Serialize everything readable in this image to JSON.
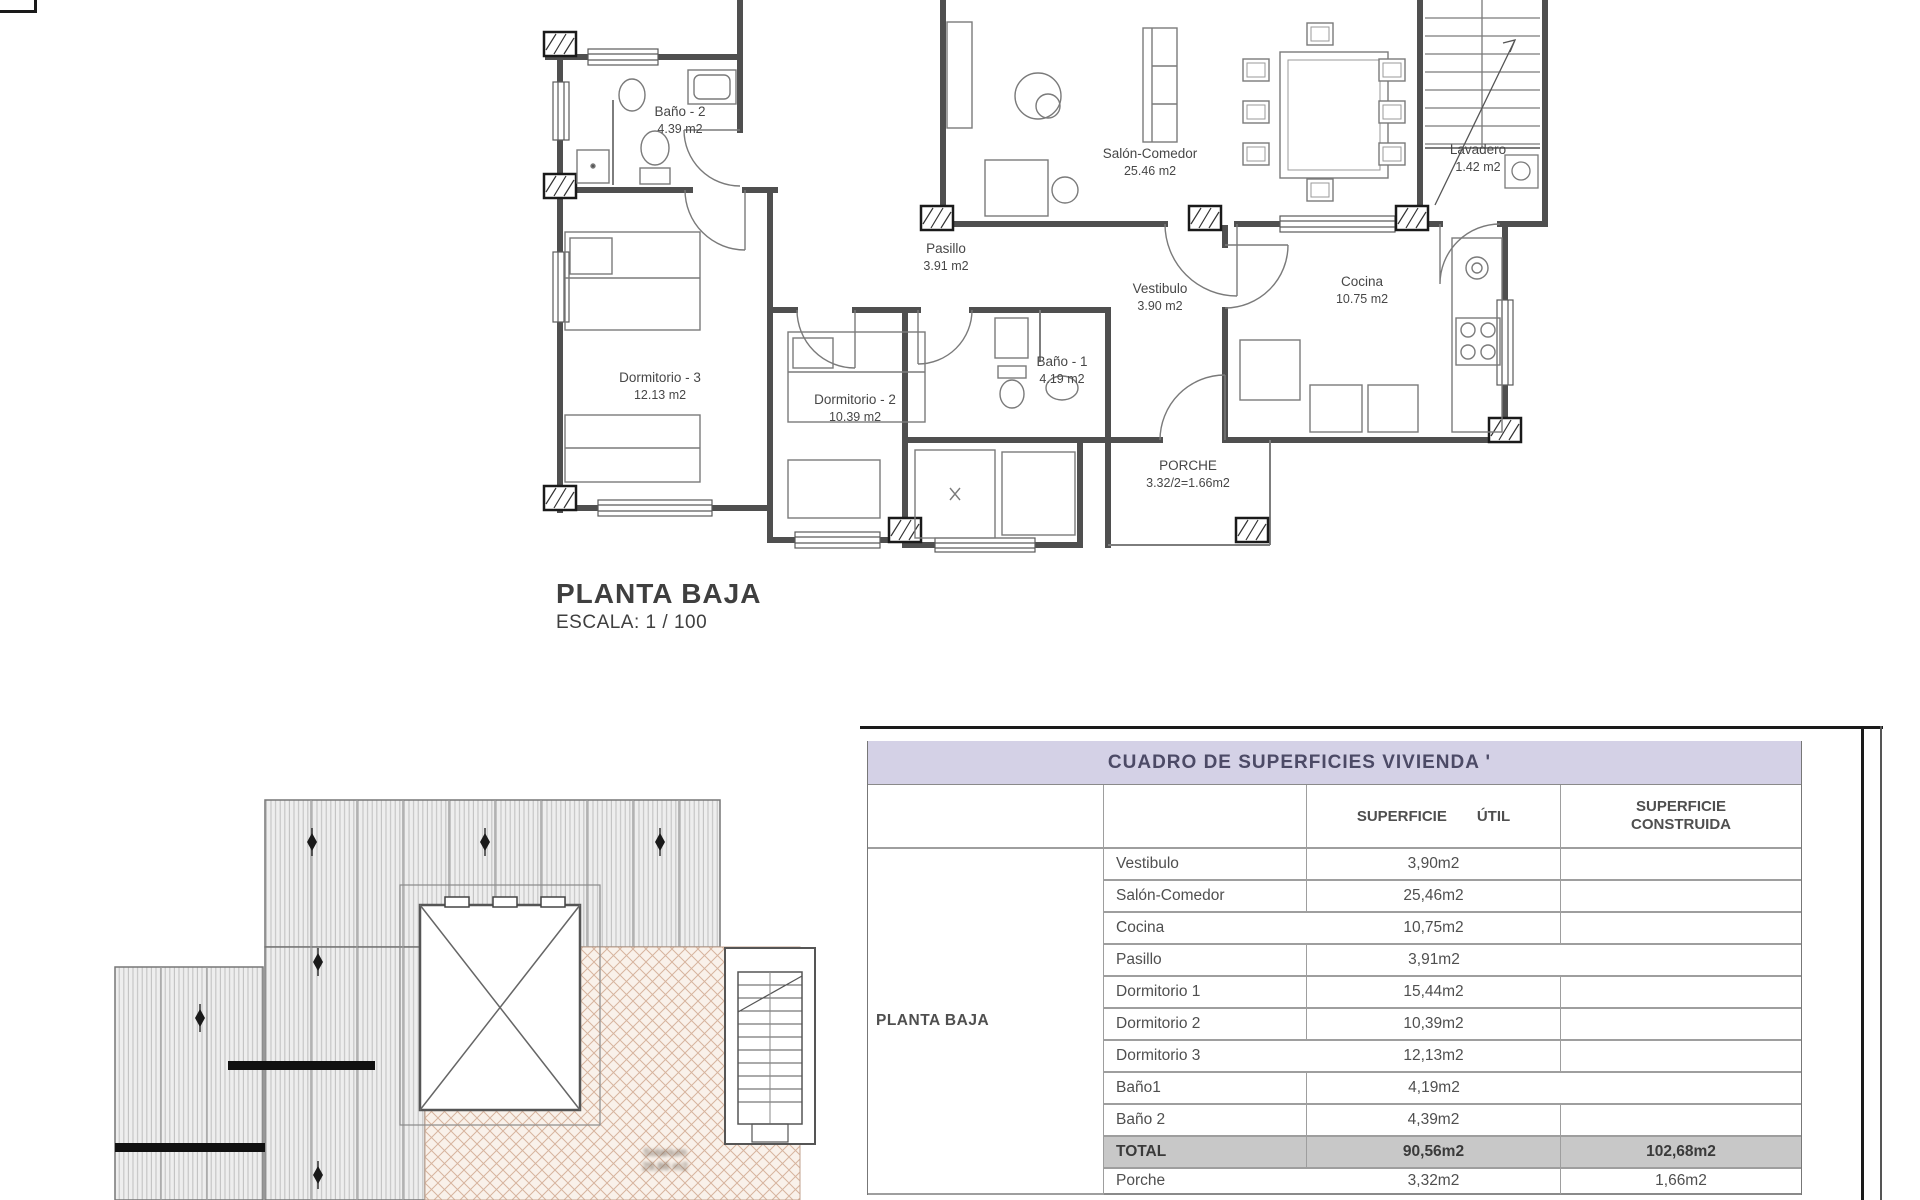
{
  "sheet": {
    "plan_title": "PLANTA BAJA",
    "plan_scale": "ESCALA: 1 / 100"
  },
  "floor_plan": {
    "rooms": [
      {
        "name": "Baño - 2",
        "area": "4.39 m2",
        "x": 680,
        "y": 116
      },
      {
        "name": "Salón-Comedor",
        "area": "25.46 m2",
        "x": 1150,
        "y": 158
      },
      {
        "name": "Lavadero",
        "area": "1.42 m2",
        "x": 1478,
        "y": 154
      },
      {
        "name": "Pasillo",
        "area": "3.91 m2",
        "x": 946,
        "y": 253
      },
      {
        "name": "Vestibulo",
        "area": "3.90 m2",
        "x": 1160,
        "y": 293
      },
      {
        "name": "Cocina",
        "area": "10.75 m2",
        "x": 1362,
        "y": 286
      },
      {
        "name": "Dormitorio - 3",
        "area": "12.13 m2",
        "x": 660,
        "y": 382
      },
      {
        "name": "Dormitorio - 2",
        "area": "10.39 m2",
        "x": 855,
        "y": 404
      },
      {
        "name": "Baño - 1",
        "area": "4.19 m2",
        "x": 1062,
        "y": 366
      },
      {
        "name": "PORCHE",
        "area": "3.32/2=1.66m2",
        "x": 1188,
        "y": 470
      }
    ]
  },
  "roof_plan": {
    "terrace_label": {
      "line1": "Solarium",
      "line2": "29,86 m2"
    }
  },
  "surfaces_table": {
    "title": "CUADRO DE SUPERFICIES  VIVIENDA '",
    "group_label": "PLANTA BAJA",
    "headers": {
      "util": [
        "SUPERFICIE",
        "ÚTIL"
      ],
      "construida": [
        "SUPERFICIE",
        "CONSTRUIDA"
      ]
    },
    "rows": [
      {
        "name": "Vestibulo",
        "util": "3,90m2",
        "construida": ""
      },
      {
        "name": "Salón-Comedor",
        "util": "25,46m2",
        "construida": ""
      },
      {
        "name": "Cocina",
        "util": "10,75m2",
        "construida": ""
      },
      {
        "name": "Pasillo",
        "util": "3,91m2",
        "construida": ""
      },
      {
        "name": "Dormitorio 1",
        "util": "15,44m2",
        "construida": ""
      },
      {
        "name": "Dormitorio 2",
        "util": "10,39m2",
        "construida": ""
      },
      {
        "name": "Dormitorio 3",
        "util": "12,13m2",
        "construida": ""
      },
      {
        "name": "Baño1",
        "util": "4,19m2",
        "construida": ""
      },
      {
        "name": "Baño 2",
        "util": "4,39m2",
        "construida": ""
      },
      {
        "name": "TOTAL",
        "util": "90,56m2",
        "construida": "102,68m2",
        "total": true
      },
      {
        "name": "Porche",
        "util": "3,32m2",
        "construida": "1,66m2"
      }
    ]
  },
  "colors": {
    "header_band": "#d4d1e6",
    "total_row": "#c8c8c8",
    "wall": "#4f4f4f",
    "roof_fill": "#eeeeee",
    "terrace_fill": "#f9f1ea",
    "terrace_line": "#d7b49e"
  }
}
